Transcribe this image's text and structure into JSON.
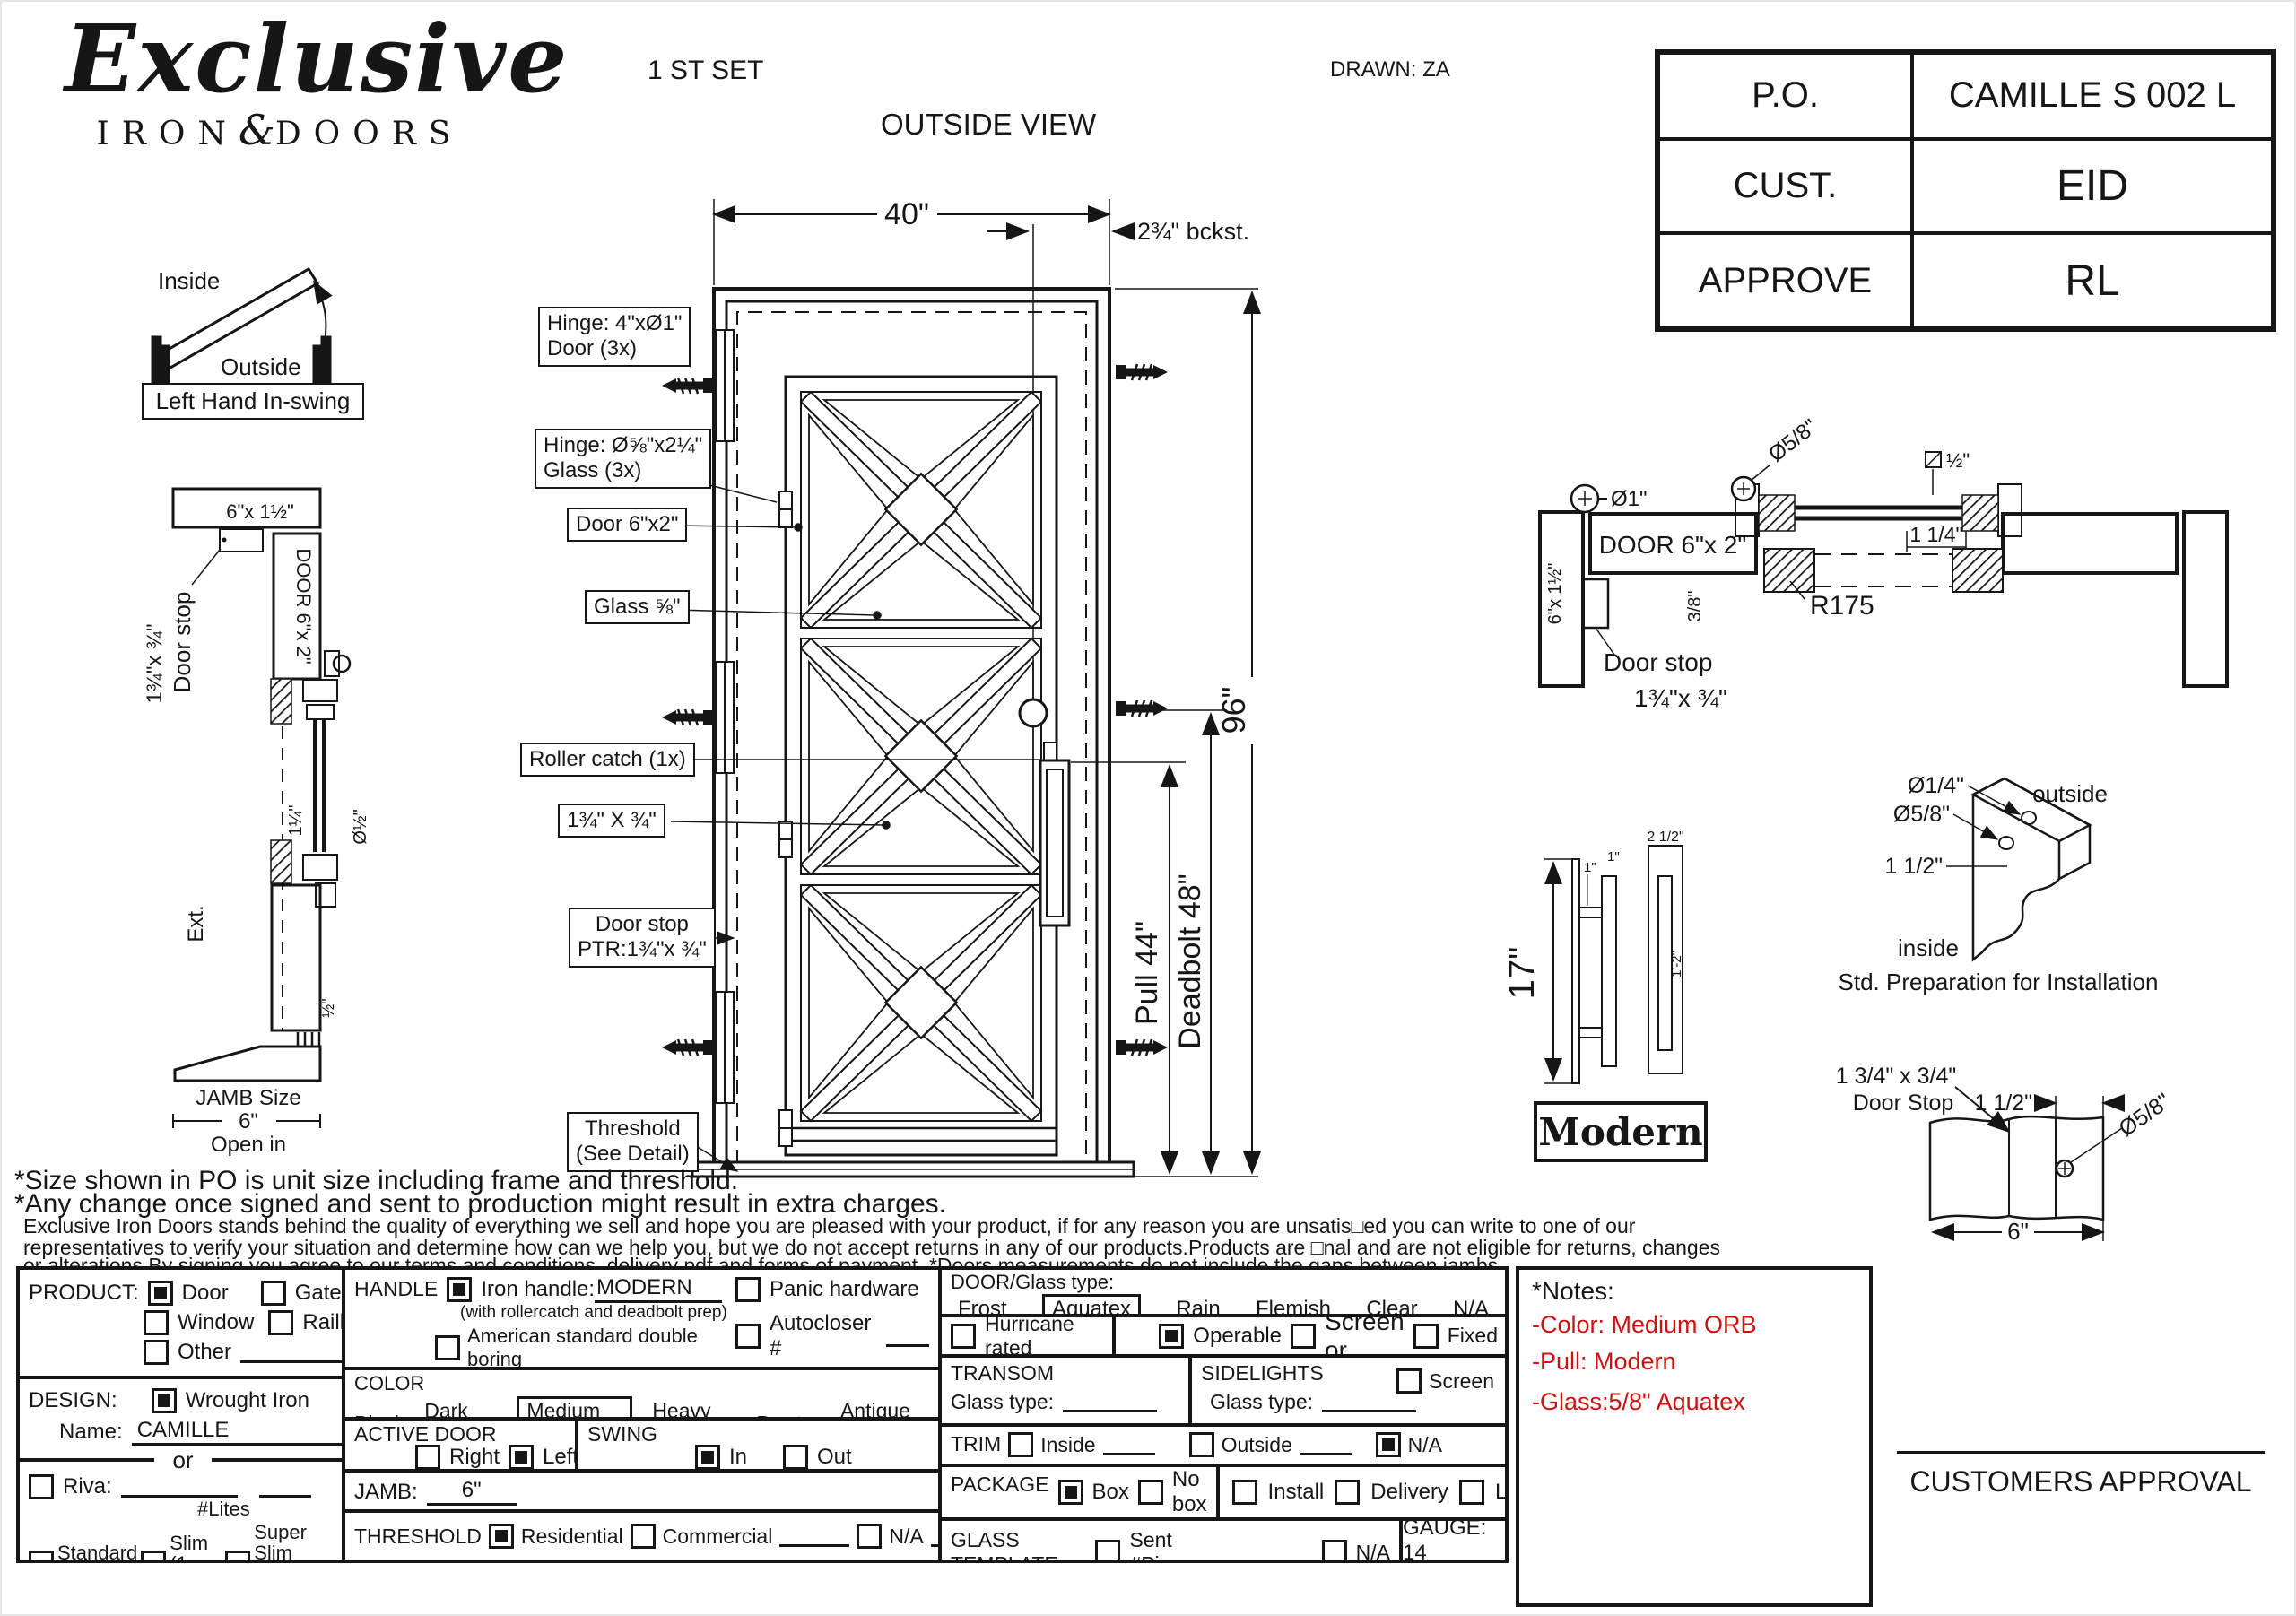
{
  "header": {
    "brand_script": "Exclusive",
    "brand_iron": "IRON",
    "brand_amp": "&",
    "brand_doors": "DOORS",
    "set": "1 ST SET",
    "view": "OUTSIDE VIEW",
    "drawn": "DRAWN: ZA",
    "po_label": "P.O.",
    "po_value": "CAMILLE S 002 L",
    "cust_label": "CUST.",
    "cust_value": "EID",
    "approve_label": "APPROVE",
    "approve_value": "RL"
  },
  "swing": {
    "inside": "Inside",
    "outside": "Outside",
    "caption": "Left Hand In-swing"
  },
  "left_section": {
    "head": "6\"x 1½\"",
    "door": "DOOR 6\"x 2\"",
    "stop1": "Door stop",
    "stop2": "1¾\"x ¾\"",
    "d114": "1¼\"",
    "d12": "Ø½\"",
    "ext": "Ext.",
    "half": "½\"",
    "jamb1": "JAMB Size",
    "jamb2": "6\"",
    "open": "Open in"
  },
  "door": {
    "w": "40\"",
    "bckst": "2¾\" bckst.",
    "h": "96\"",
    "pull": "Pull 44\"",
    "deadbolt": "Deadbolt 48\"",
    "hinge_door1": "Hinge: 4\"xØ1\"",
    "hinge_door2": "Door (3x)",
    "hinge_glass1": "Hinge: Ø⅝\"x2¼\"",
    "hinge_glass2": "Glass (3x)",
    "door_lbl": "Door 6\"x2\"",
    "glass_lbl": "Glass ⅝\"",
    "roller": "Roller catch  (1x)",
    "bar": "1¾\" X ¾\"",
    "stop1": "Door stop",
    "stop2": "PTR:1¾\"x ¾\"",
    "thr1": "Threshold",
    "thr2": "(See Detail)"
  },
  "head_section": {
    "d1": "Ø1\"",
    "d58": "Ø5/8\"",
    "half": "½\"",
    "door": "DOOR 6\"x 2\"",
    "d114": "1 1/4\"",
    "r": "R175",
    "jamb": "6\"x 1½\"",
    "d38": "3/8\"",
    "stop1": "Door stop",
    "stop2": "1¾\"x ¾\""
  },
  "pull_detail": {
    "h": "17\"",
    "one_a": "1\"",
    "one_b": "1\"",
    "top": "2 1/2\"",
    "inner": "1'-2\"",
    "name": "Modern"
  },
  "prep_detail": {
    "d14": "Ø1/4\"",
    "d58": "Ø5/8\"",
    "d112": "1 1/2\"",
    "outside": "outside",
    "inside": "inside",
    "caption": "Std. Preparation for Installation"
  },
  "stop_detail": {
    "t1": "1 3/4\" x 3/4\"",
    "t2": "Door Stop",
    "d112": "1 1/2\"",
    "d58": "Ø5/8\"",
    "six": "6\""
  },
  "notes": {
    "l1": "*Size shown in PO is unit size including frame and threshold.",
    "l2": "*Any change once signed and sent to production might result in extra charges.",
    "l3": "Exclusive Iron Doors stands behind the quality of everything we sell and hope you are pleased with your product, if for any reason you are unsatis□ed you can write to one of our",
    "l4": "representatives to verify your situation and determine how can we help you, but we do not accept returns in any of our products.Products are □nal and are not eligible for returns, changes",
    "l5": "or alterations.By signing you agree to our terms and conditions, delivery pdf and forms of payment. *Doors measurements do not include the gaps between jambs"
  },
  "red_notes": {
    "title": "*Notes:",
    "i1": "-Color: Medium ORB",
    "i2": "-Pull: Modern",
    "i3": "-Glass:5/8\"  Aquatex"
  },
  "approval": {
    "label": "CUSTOMERS APPROVAL"
  },
  "form": {
    "product": {
      "label": "PRODUCT:",
      "door": "Door",
      "door_on": true,
      "gate": "Gate",
      "window": "Window",
      "railling": "Railling",
      "other": "Other"
    },
    "design": {
      "label": "DESIGN:",
      "wrought": "Wrought Iron",
      "wrought_on": true,
      "name_label": "Name:",
      "name_value": "CAMILLE",
      "or": "or"
    },
    "riva": {
      "label": "Riva:",
      "lites": "#Lites",
      "standard": "Standard",
      "standard_s": "(1 1/2”)",
      "slim": "Slim",
      "slim_s": "(1 1/4”)",
      "superslim": "Super Slim",
      "superslim_s": "(1/2”) SDL"
    },
    "handle": {
      "label": "HANDLE",
      "iron": "Iron handle:",
      "iron_value": "MODERN",
      "iron_on": true,
      "iron_sub": "(with rollercatch and deadbolt prep)",
      "american": "American standard double boring",
      "other": "Other:",
      "panic": "Panic hardware",
      "autocloser": "Autocloser #",
      "pbar": "P. Bar #"
    },
    "color": {
      "label": "COLOR",
      "o": [
        {
          "t": "Black"
        },
        {
          "t": "Dark ORB"
        },
        {
          "t": "Medium ORB",
          "sel": true
        },
        {
          "t": "Heavy ORB"
        },
        {
          "t": "Pewter"
        },
        {
          "t": "Antique gold"
        }
      ]
    },
    "active": {
      "label": "ACTIVE DOOR",
      "right": "Right",
      "left": "Left",
      "left_on": true
    },
    "swing": {
      "label": "SWING",
      "in": "In",
      "in_on": true,
      "out": "Out"
    },
    "jamb": {
      "label": "JAMB:",
      "value": "6\""
    },
    "threshold": {
      "label": "THRESHOLD",
      "residential": "Residential",
      "residential_on": true,
      "commercial": "Commercial",
      "na": "N/A"
    },
    "glass": {
      "label": "DOOR/Glass type:",
      "o": [
        {
          "t": "Frost"
        },
        {
          "t": "Aquatex",
          "sel": true
        },
        {
          "t": "Rain"
        },
        {
          "t": "Flemish"
        },
        {
          "t": "Clear"
        },
        {
          "t": "N/A"
        }
      ]
    },
    "hurricane": {
      "label": "Hurricane rated"
    },
    "operable": {
      "operable": "Operable",
      "operable_on": true,
      "screen_or": "Screen or",
      "fixed": "Fixed"
    },
    "transom": {
      "label": "TRANSOM",
      "glass": "Glass type:"
    },
    "sidelights": {
      "label": "SIDELIGHTS",
      "glass": "Glass type:",
      "screen": "Screen"
    },
    "trim": {
      "label": "TRIM",
      "inside": "Inside",
      "outside": "Outside",
      "na": "N/A",
      "na_on": true
    },
    "package": {
      "label": "PACKAGE",
      "box": "Box",
      "box_on": true,
      "nobox": "No box",
      "install": "Install",
      "delivery": "Delivery",
      "ltl": "LTL"
    },
    "template_row": {
      "label": "GLASS TEMPLATE",
      "sent": "Sent #Pieces:",
      "na": "N/A"
    },
    "gauge": "GAUGE: 14"
  }
}
